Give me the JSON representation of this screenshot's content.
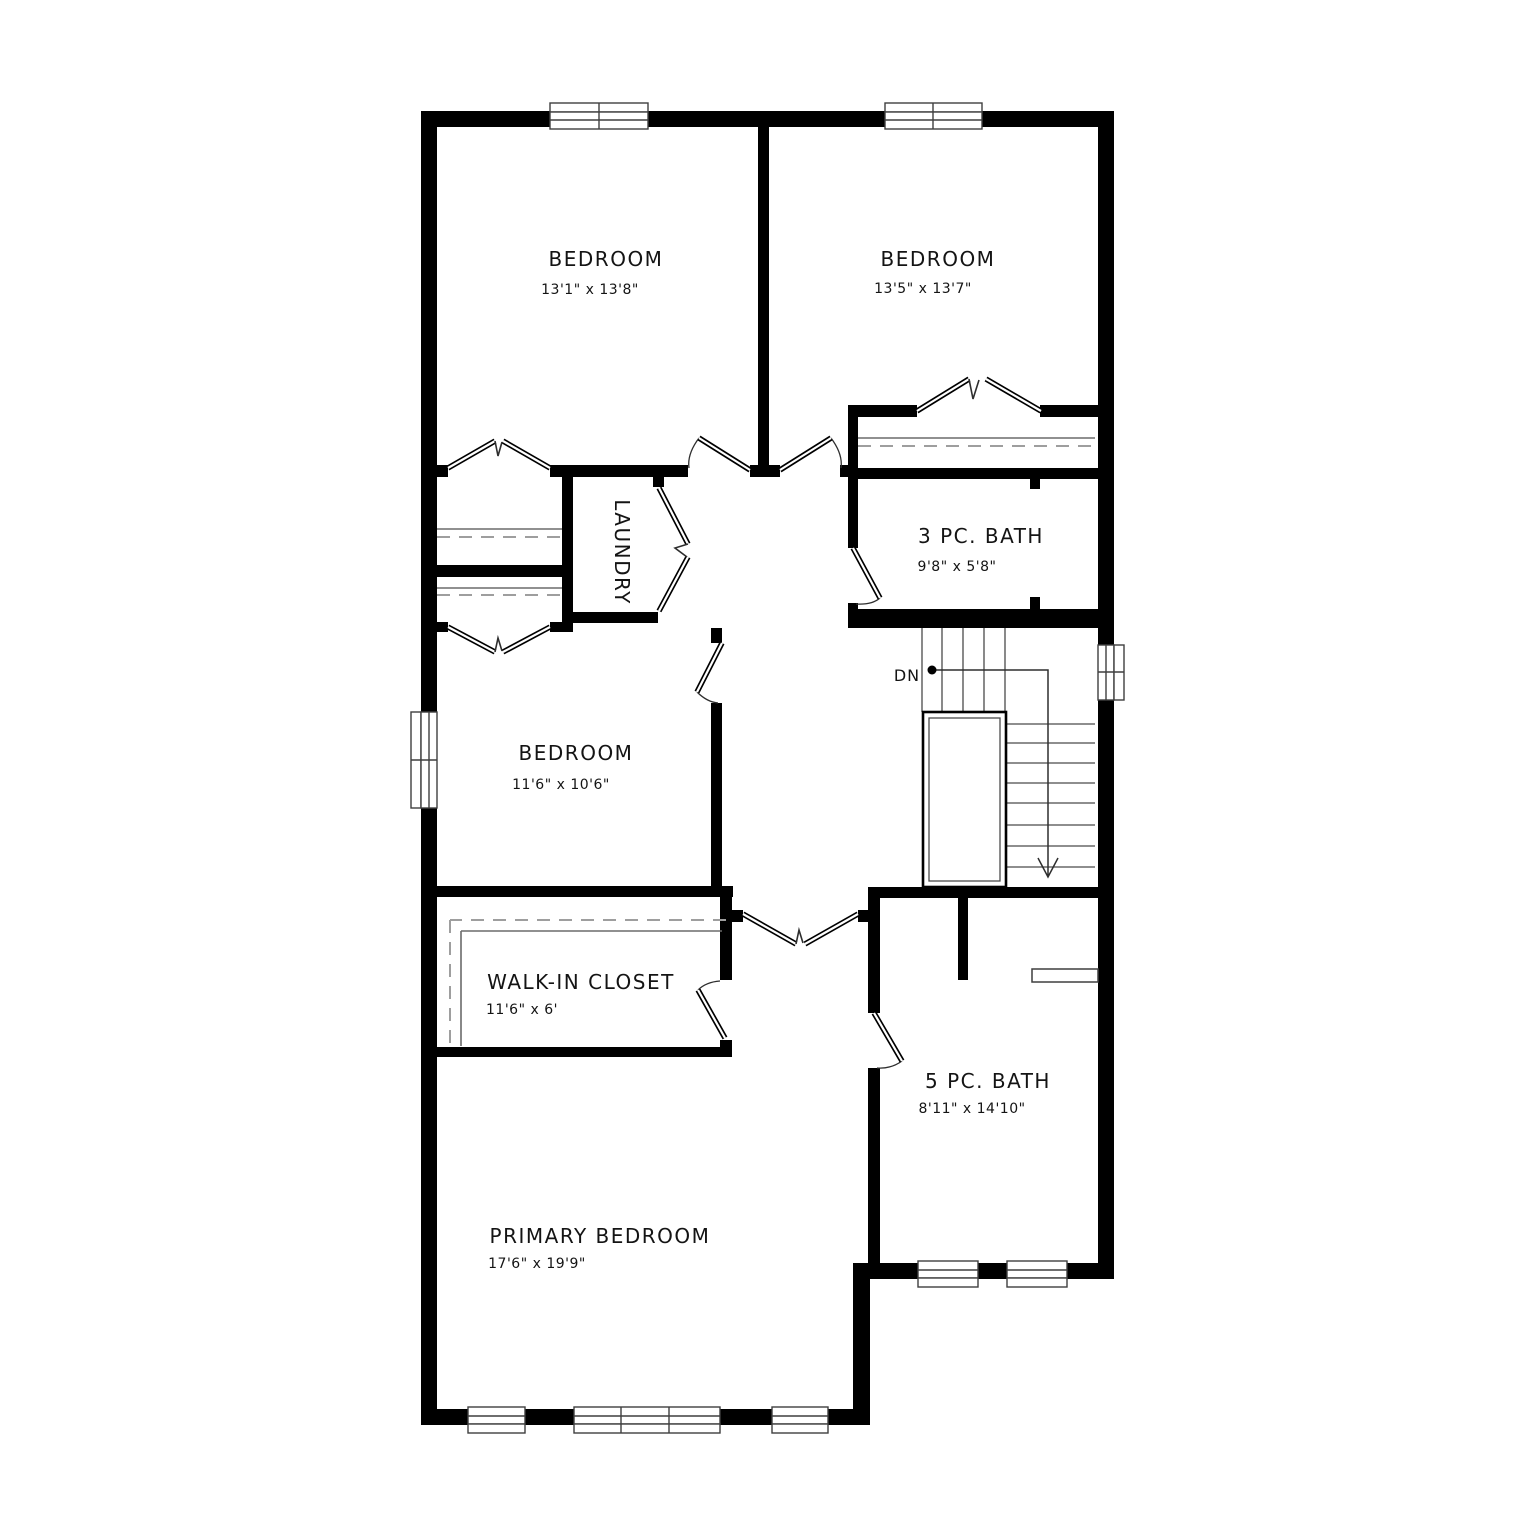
{
  "plan": {
    "rooms": {
      "bedroom_top_left": {
        "name": "BEDROOM",
        "dims": "13'1\" x 13'8\""
      },
      "bedroom_top_right": {
        "name": "BEDROOM",
        "dims": "13'5\" x 13'7\""
      },
      "bedroom_middle": {
        "name": "BEDROOM",
        "dims": "11'6\" x 10'6\""
      },
      "laundry": {
        "name": "LAUNDRY"
      },
      "bath_3pc": {
        "name": "3 PC. BATH",
        "dims": "9'8\" x 5'8\""
      },
      "walk_in_closet": {
        "name": "WALK-IN CLOSET",
        "dims": "11'6\" x 6'"
      },
      "bath_5pc": {
        "name": "5 PC. BATH",
        "dims": "8'11\" x 14'10\""
      },
      "primary_bedroom": {
        "name": "PRIMARY BEDROOM",
        "dims": "17'6\" x 19'9\""
      }
    },
    "stairs": {
      "down_label": "DN"
    },
    "colors": {
      "wall": "#000000",
      "background": "#ffffff",
      "line": "#3f3f3f",
      "dash": "#9e9e9e"
    }
  }
}
